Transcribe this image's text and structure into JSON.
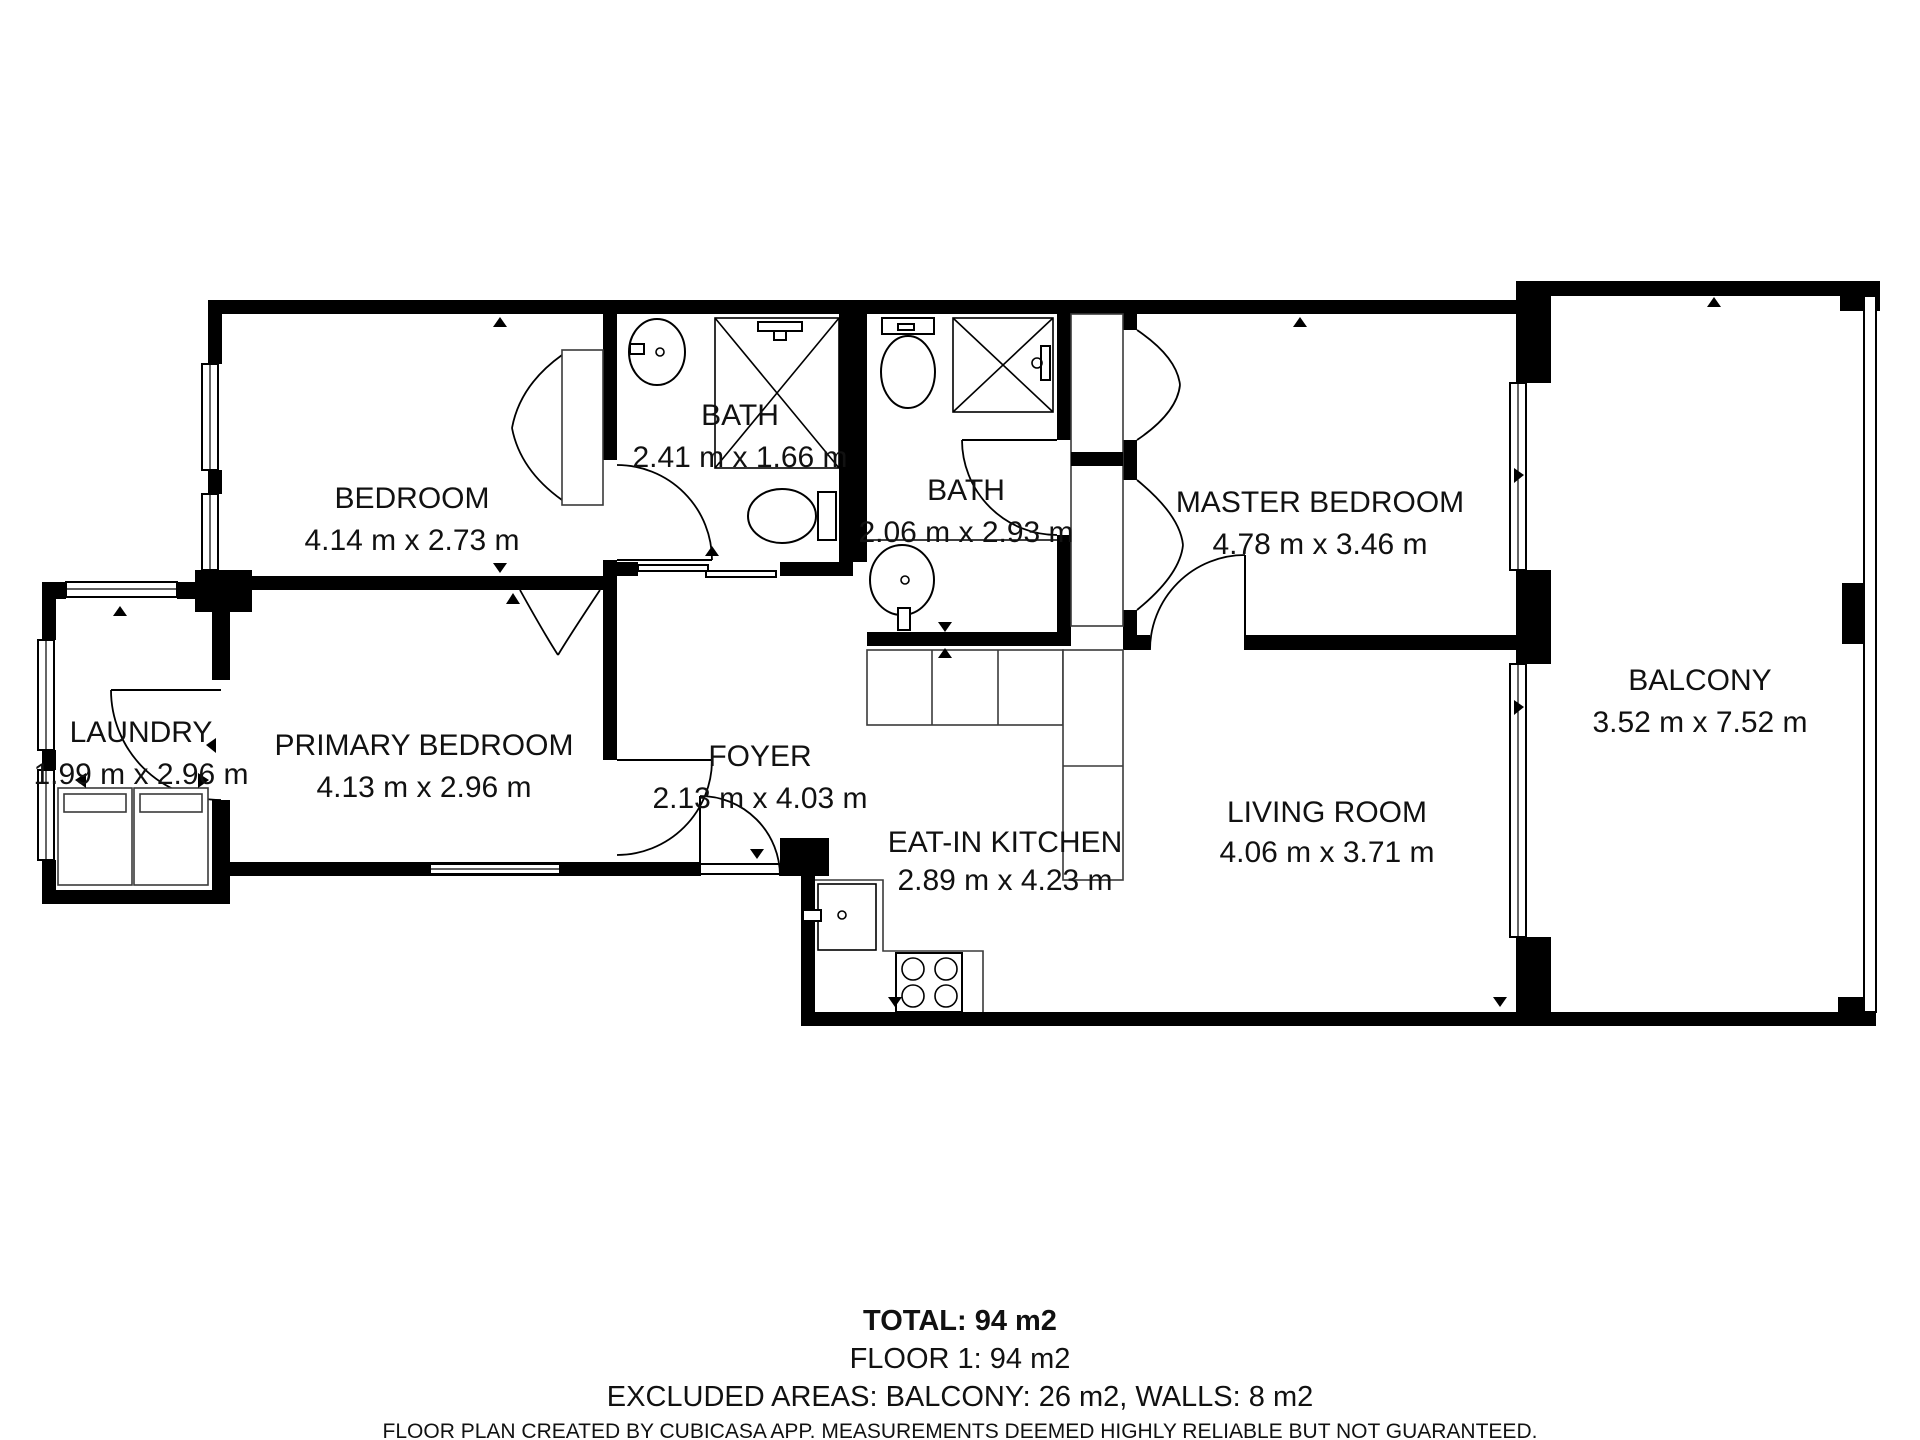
{
  "rooms": [
    {
      "name": "BEDROOM",
      "dims": "4.14 m x 2.73 m"
    },
    {
      "name": "BATH",
      "dims": "2.41 m x 1.66 m"
    },
    {
      "name": "BATH",
      "dims": "2.06 m x 2.93 m"
    },
    {
      "name": "MASTER BEDROOM",
      "dims": "4.78 m x 3.46 m"
    },
    {
      "name": "BALCONY",
      "dims": "3.52 m x 7.52 m"
    },
    {
      "name": "LAUNDRY",
      "dims": "1.99 m x 2.96 m"
    },
    {
      "name": "PRIMARY BEDROOM",
      "dims": "4.13 m x 2.96 m"
    },
    {
      "name": "FOYER",
      "dims": "2.13 m x 4.03 m"
    },
    {
      "name": "EAT-IN KITCHEN",
      "dims": "2.89 m x 4.23 m"
    },
    {
      "name": "LIVING ROOM",
      "dims": "4.06 m x 3.71 m"
    }
  ],
  "summary": {
    "total": "TOTAL: 94 m2",
    "floor": "FLOOR 1: 94 m2",
    "excluded": "EXCLUDED AREAS: BALCONY: 26 m2, WALLS: 8 m2"
  },
  "footer": {
    "disclaimer": "FLOOR PLAN CREATED BY CUBICASA APP. MEASUREMENTS DEEMED HIGHLY RELIABLE BUT NOT GUARANTEED."
  },
  "colors": {
    "wall": "#000000",
    "background": "#ffffff",
    "text": "#111111"
  }
}
